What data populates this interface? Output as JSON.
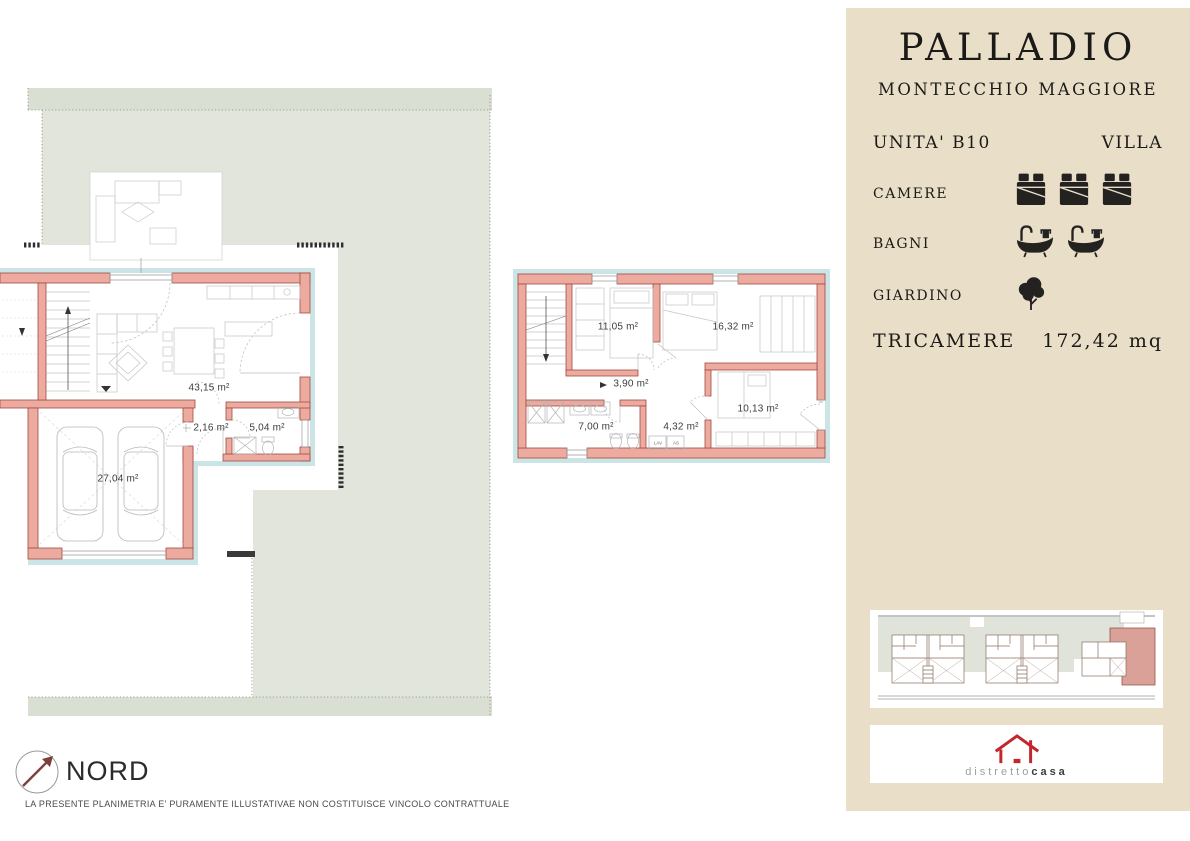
{
  "panel": {
    "title": "PALLADIO",
    "subtitle": "MONTECCHIO MAGGIORE",
    "unit_label": "UNITA' B10",
    "unit_type": "VILLA",
    "features": [
      {
        "label": "CAMERE",
        "icon": "bed-icon",
        "count": 3
      },
      {
        "label": "BAGNI",
        "icon": "bathtub-icon",
        "count": 2
      },
      {
        "label": "GIARDINO",
        "icon": "tree-icon",
        "count": 1
      }
    ],
    "summary_label": "TRICAMERE",
    "summary_value": "172,42 mq"
  },
  "brand": {
    "logo_prefix": "distretto",
    "logo_suffix": "casa",
    "logo_icon": "house-logo-icon"
  },
  "plan": {
    "ground_floor": {
      "rooms": [
        {
          "name": "living-kitchen",
          "area": "43,15 m²"
        },
        {
          "name": "hallway",
          "area": "2,16 m²"
        },
        {
          "name": "bathroom",
          "area": "5,04 m²"
        },
        {
          "name": "garage",
          "area": "27,04 m²"
        }
      ]
    },
    "first_floor": {
      "rooms": [
        {
          "name": "bedroom-1",
          "area": "11,05 m²"
        },
        {
          "name": "bedroom-2",
          "area": "16,32 m²"
        },
        {
          "name": "hallway",
          "area": "3,90 m²"
        },
        {
          "name": "bathroom",
          "area": "7,00 m²"
        },
        {
          "name": "laundry",
          "area": "4,32 m²"
        },
        {
          "name": "bedroom-3",
          "area": "10,13 m²"
        }
      ],
      "fixture_labels": {
        "lav": "LAV",
        "as": "AS"
      }
    }
  },
  "footer": {
    "north_label": "NORD",
    "north_icon": "north-compass-icon",
    "disclaimer": "LA PRESENTE PLANIMETRIA E' PURAMENTE ILLUSTATIVAE NON COSTITUISCE VINCOLO CONTRATTUALE"
  },
  "colors": {
    "panel_bg": "#e9dfc9",
    "wall_fill": "#edaba0",
    "wall_stroke": "#a04a40",
    "garden": "#e1e5dc",
    "garden_band": "#dadfd4",
    "exterior_band": "#cbe5e7",
    "highlight_unit": "#d9a198",
    "logo_red": "#c1272d",
    "ink": "#242220"
  }
}
